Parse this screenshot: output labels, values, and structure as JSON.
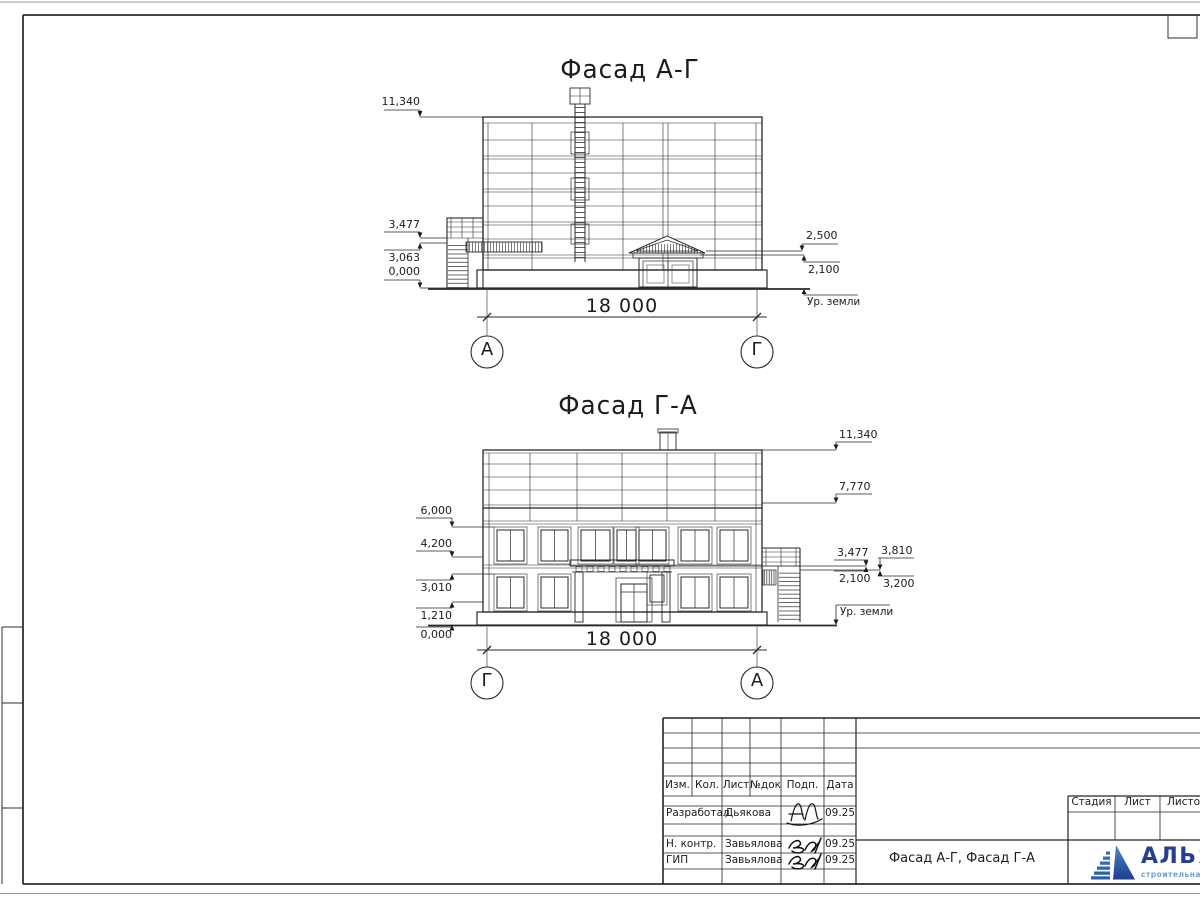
{
  "facade1": {
    "title": "Фасад А-Г",
    "dim_total": "18 000",
    "axis_left": "А",
    "axis_right": "Г",
    "marks_left": [
      "11,340",
      "3,477",
      "3,063",
      "0,000"
    ],
    "marks_right": [
      "2,500",
      "2,100"
    ],
    "ground": "Ур. земли"
  },
  "facade2": {
    "title": "Фасад Г-А",
    "dim_total": "18 000",
    "axis_left": "Г",
    "axis_right": "А",
    "marks_left": [
      "6,000",
      "4,200",
      "3,010",
      "1,210",
      "0,000"
    ],
    "marks_right": [
      "11,340",
      "7,770",
      "3,477",
      "3,810",
      "2,100",
      "3,200"
    ],
    "ground": "Ур. земли"
  },
  "titleblock": {
    "col_izm": "Изм.",
    "col_kol": "Кол.",
    "col_list": "Лист",
    "col_ndok": "№док",
    "col_podp": "Подп.",
    "col_data": "Дата",
    "row1_role": "Разработал",
    "row1_name": "Дьякова",
    "row1_date": "09.25",
    "row2_role": "Н. контр.",
    "row2_name": "Завьялова",
    "row2_date": "09.25",
    "row3_role": "ГИП",
    "row3_name": "Завьялова",
    "row3_date": "09.25",
    "doc_name": "Фасад А-Г, Фасад Г-А",
    "stage_label": "Стадия",
    "sheet_label": "Лист",
    "sheets_label": "Листов",
    "logo_name": "АЛЬЯНС",
    "logo_subtitle": "строительная компания",
    "logo_color": "#233f94",
    "logo_subtitle_color": "#6f9fd8"
  }
}
